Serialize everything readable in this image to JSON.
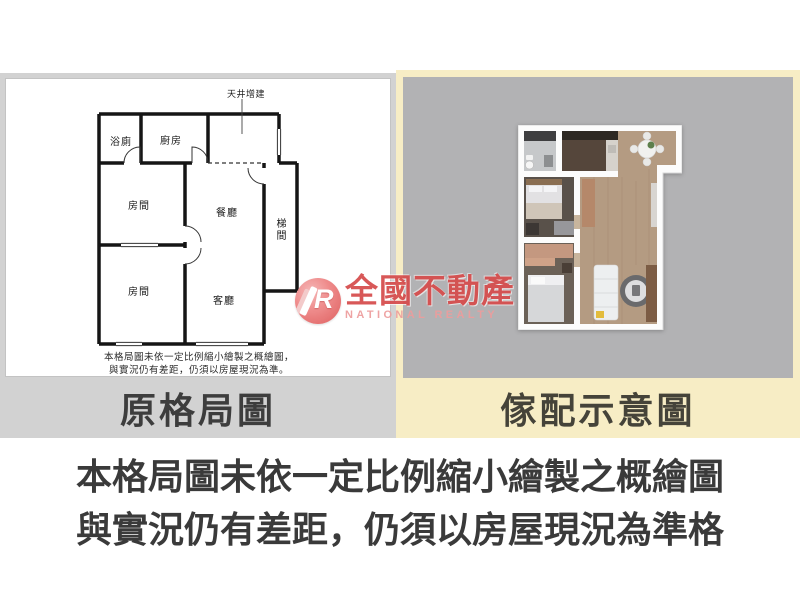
{
  "left_panel": {
    "label": "原格局圖",
    "floorplan": {
      "annotation_top": "天井增建",
      "rooms": {
        "bathroom": "浴廁",
        "kitchen": "廚房",
        "bedroom1": "房間",
        "bedroom2": "房間",
        "dining": "餐廳",
        "living": "客廳",
        "stairs": "梯間"
      },
      "disclaimer_line1": "本格局圖未依一定比例縮小繪製之概繪圖，",
      "disclaimer_line2": "與實況仍有差距，仍須以房屋現況為準。"
    }
  },
  "right_panel": {
    "label": "傢配示意圖"
  },
  "watermark": {
    "logo_letter": "R",
    "brand_cn": "全國不動產",
    "brand_en": "NATIONAL REALTY"
  },
  "footer": {
    "line1": "本格局圖未依一定比例縮小繪製之概繪圖",
    "line2": "與實況仍有差距，仍須以房屋現況為準格"
  },
  "colors": {
    "left_band_bg": "#d2d2d2",
    "right_band_bg": "#f7edc5",
    "right_inner_gray": "#b2b2b4",
    "label_text": "#3d3d3d",
    "brand_red": "#d64c4c",
    "brand_pink": "#ed9d9d",
    "footer_text": "#3a3a3a"
  }
}
